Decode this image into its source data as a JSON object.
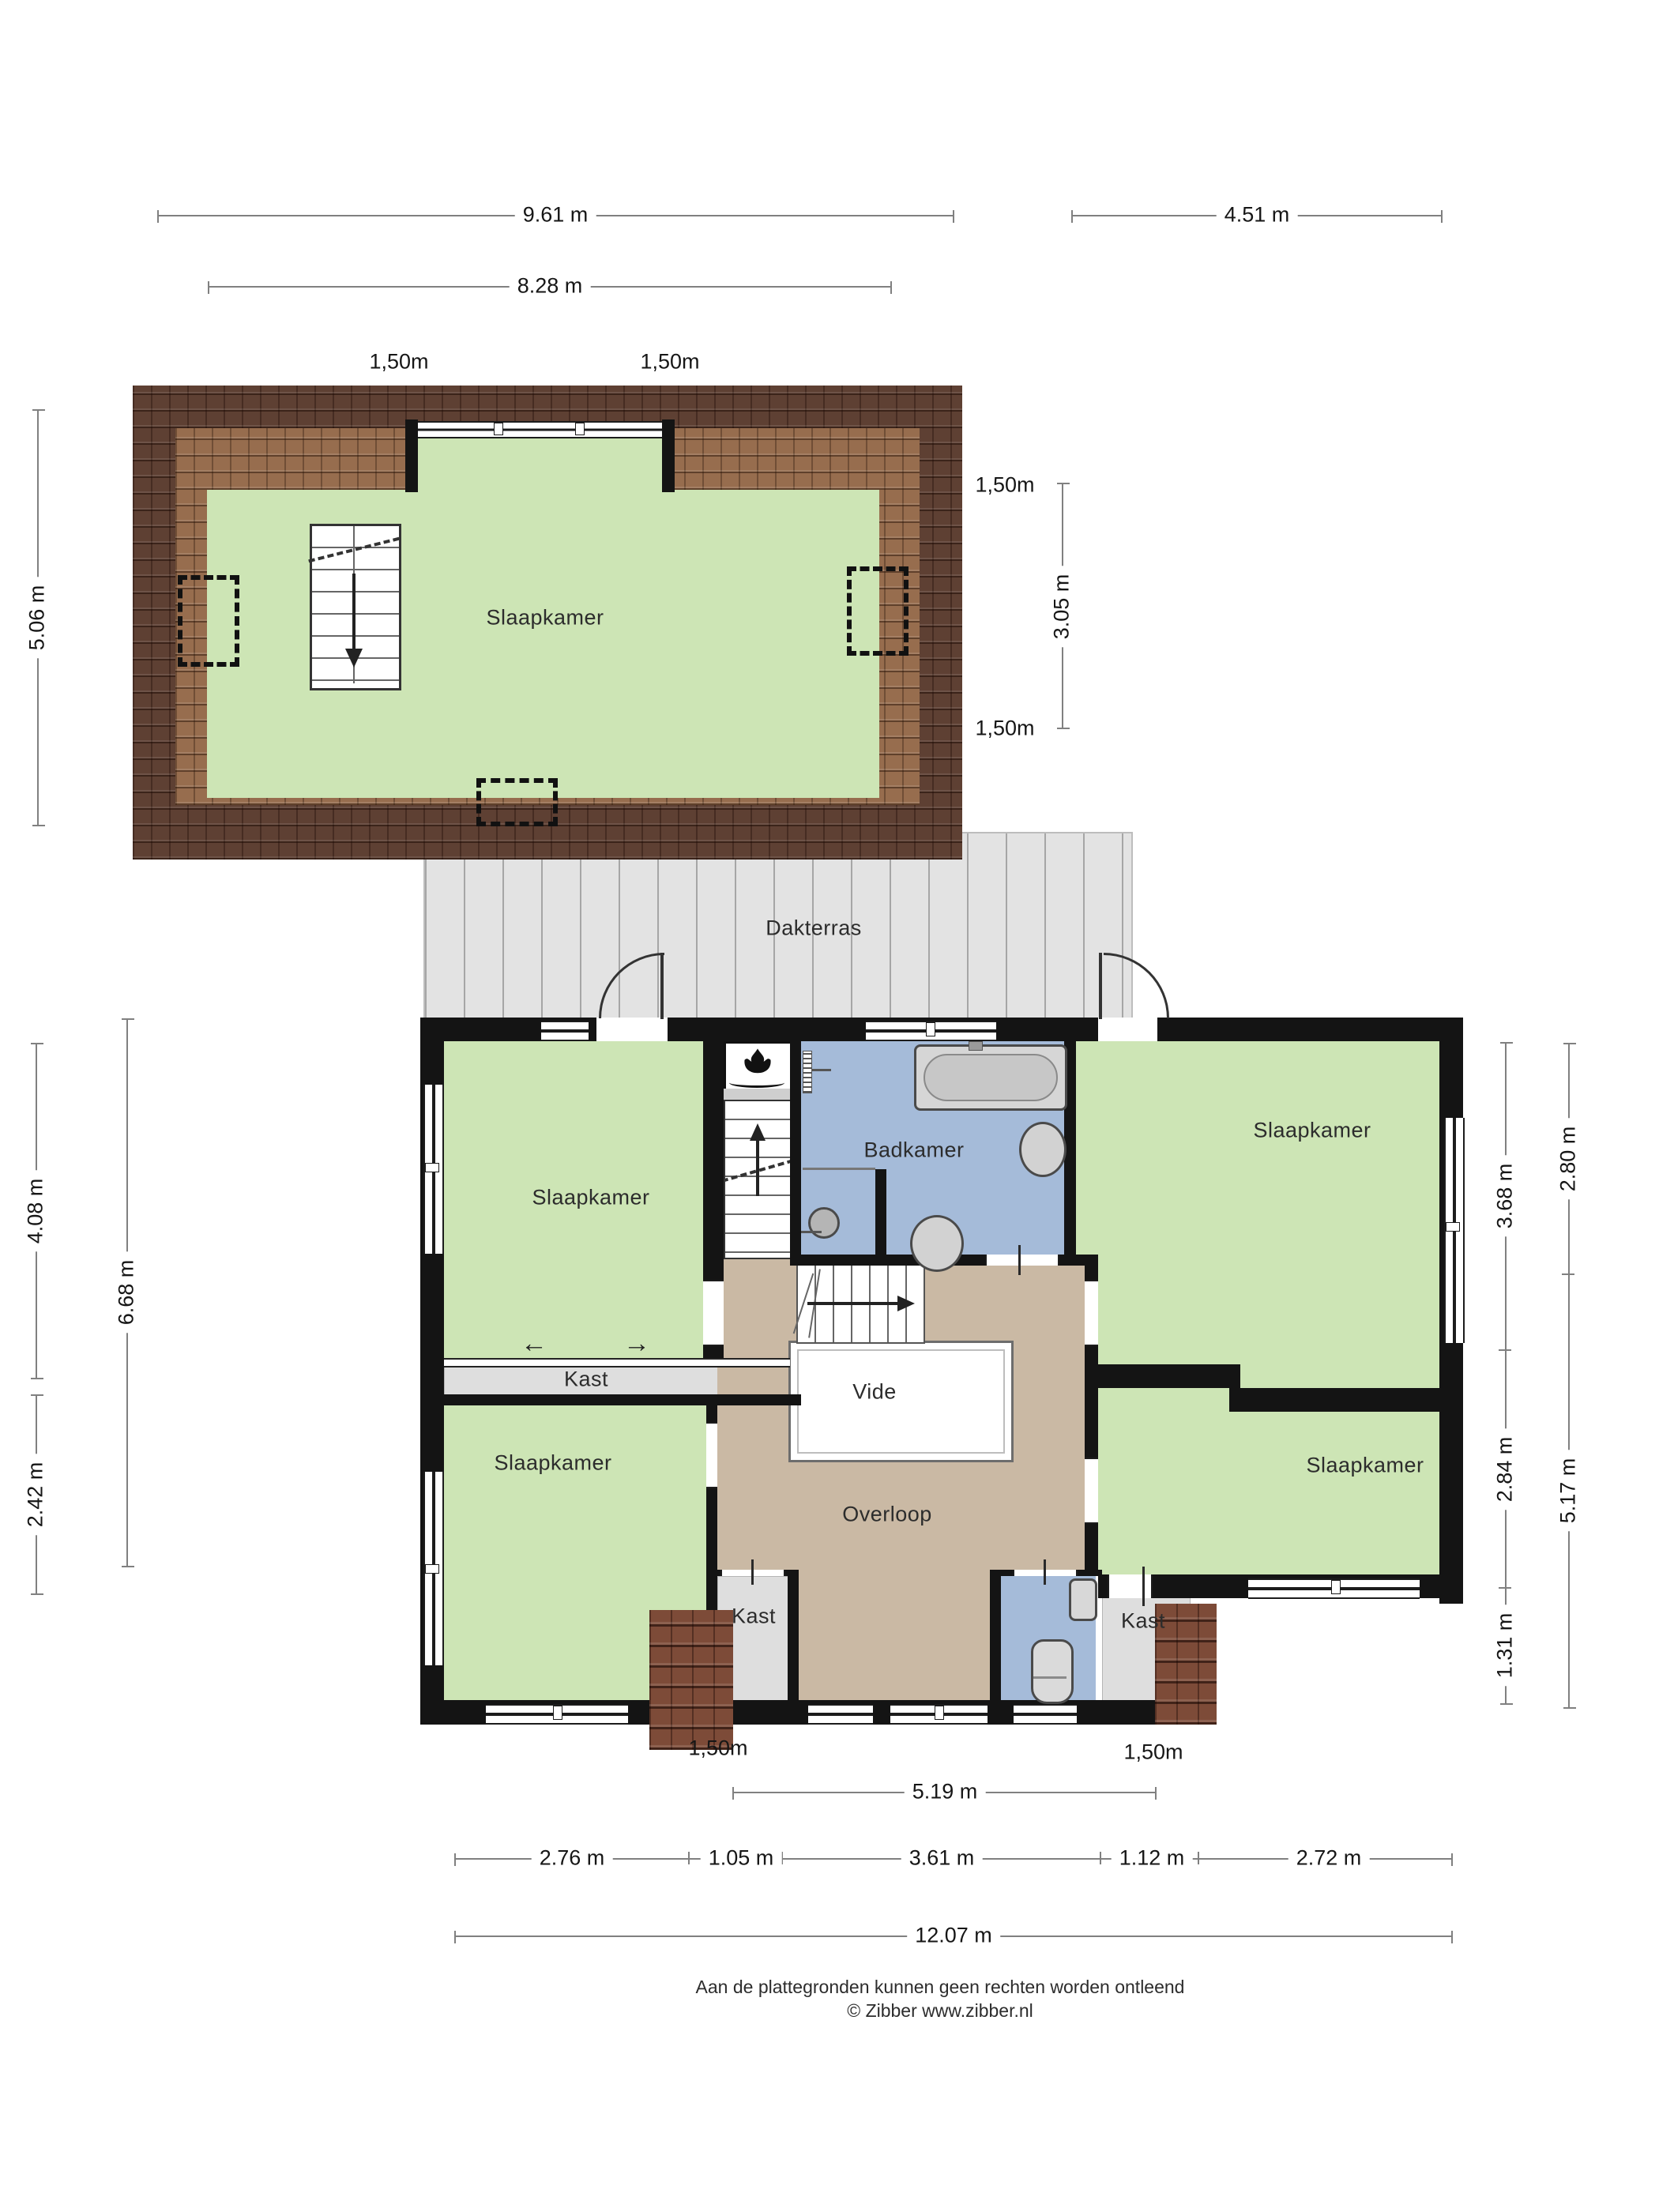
{
  "rooms": {
    "attic_bedroom": "Slaapkamer",
    "dakterras": "Dakterras",
    "bedroom_nw": "Slaapkamer",
    "badkamer": "Badkamer",
    "bedroom_ne": "Slaapkamer",
    "bedroom_sw": "Slaapkamer",
    "bedroom_se": "Slaapkamer",
    "kast_hall": "Kast",
    "kast_sw": "Kast",
    "kast_se": "Kast",
    "vide": "Vide",
    "overloop": "Overloop"
  },
  "dims": {
    "attic_total_width": "9.61 m",
    "attic_inner_width": "8.28 m",
    "terrace_width": "4.51 m",
    "attic_height_left": "5.06 m",
    "attic_head_left": "1,50m",
    "attic_head_right": "1,50m",
    "attic_right_top": "1,50m",
    "attic_right_mid": "3.05 m",
    "attic_right_bottom": "1,50m",
    "floor_left_top": "4.08 m",
    "floor_left_bottom": "2.42 m",
    "floor_left_inner": "6.68 m",
    "floor_right_inner_top": "3.68 m",
    "floor_right_inner_mid": "2.84 m",
    "floor_right_inner_bottom": "1.31 m",
    "floor_right_outer_top": "2.80 m",
    "floor_right_outer_bottom": "5.17 m",
    "bottom_head_left": "1,50m",
    "bottom_head_right": "1,50m",
    "bottom_mid": "5.19 m",
    "bottom_segments": [
      "2.76 m",
      "1.05 m",
      "3.61 m",
      "1.12 m",
      "2.72 m"
    ],
    "bottom_total": "12.07 m"
  },
  "symbols": {
    "slide_left": "←",
    "slide_right": "→"
  },
  "footer": {
    "line1": "Aan de plattegronden kunnen geen rechten worden ontleend",
    "line2": "© Zibber www.zibber.nl"
  }
}
